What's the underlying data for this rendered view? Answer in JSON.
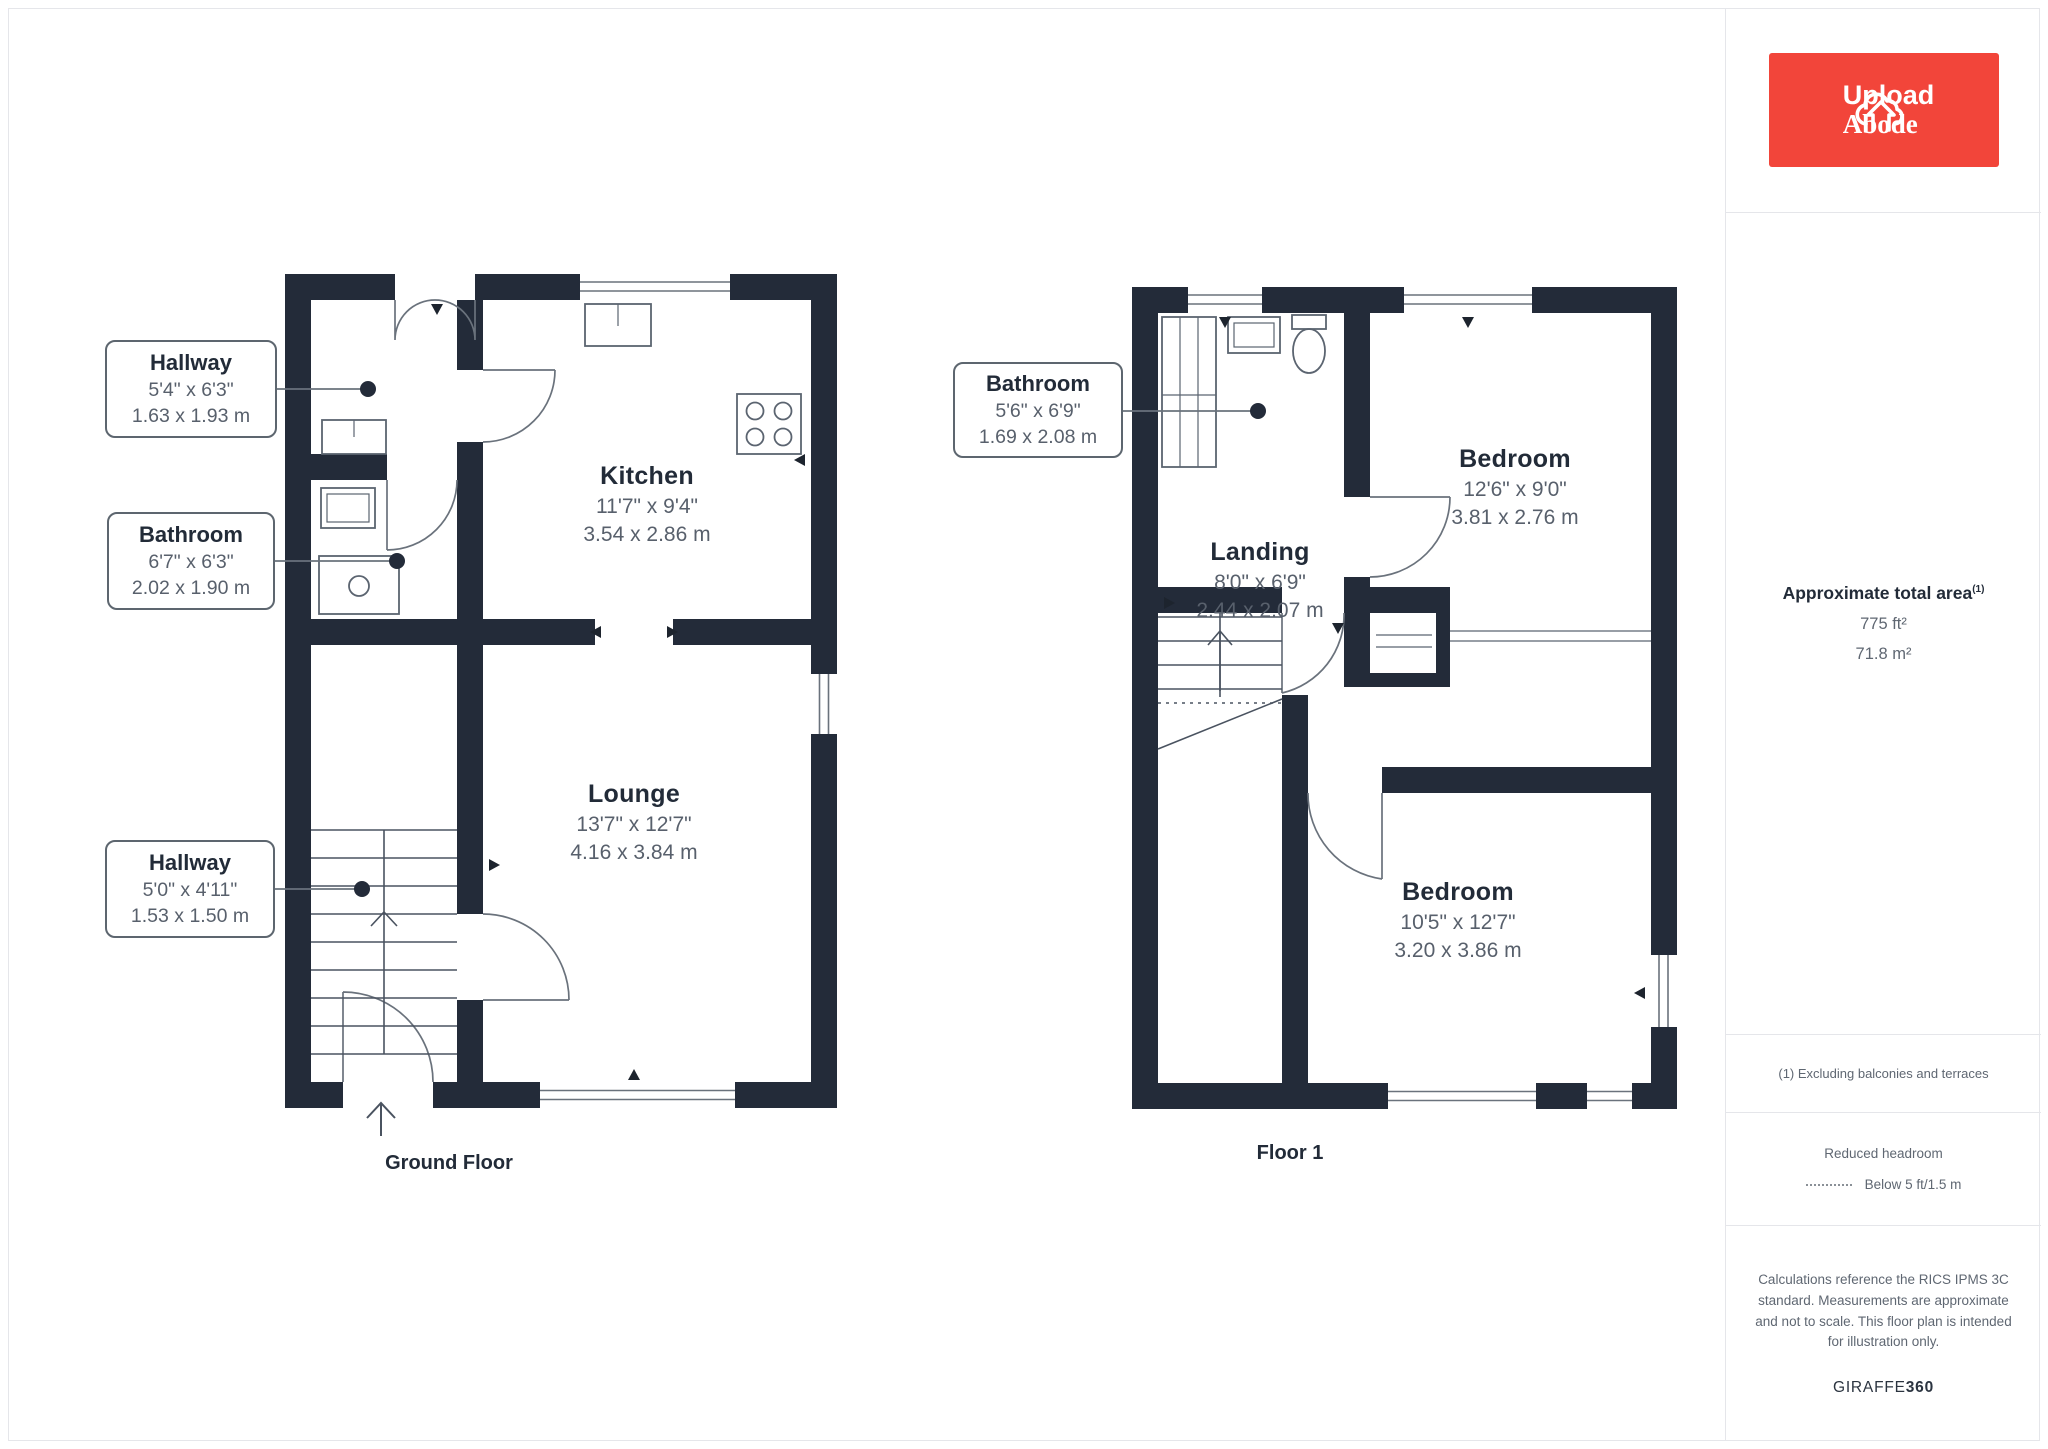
{
  "brand": {
    "logo_line1": "Upload",
    "logo_line2": "Abode"
  },
  "sidebar": {
    "area_title": "Approximate total area",
    "area_note_ref": "(1)",
    "area_imperial": "775 ft²",
    "area_metric": "71.8 m²",
    "footnote": "(1) Excluding balconies and terraces",
    "headroom_title": "Reduced headroom",
    "headroom_legend": "Below 5 ft/1.5 m",
    "disclaimer": "Calculations reference the RICS IPMS 3C standard. Measurements are approximate and not to scale. This floor plan is intended for illustration only.",
    "brand_name": "GIRAFFE",
    "brand_suffix": "360"
  },
  "ground_floor": {
    "caption": "Ground Floor",
    "rooms": {
      "kitchen": {
        "name": "Kitchen",
        "imperial": "11'7\" x 9'4\"",
        "metric": "3.54 x 2.86 m"
      },
      "lounge": {
        "name": "Lounge",
        "imperial": "13'7\" x 12'7\"",
        "metric": "4.16 x 3.84 m"
      }
    },
    "tags": {
      "hallway_top": {
        "name": "Hallway",
        "imperial": "5'4\" x 6'3\"",
        "metric": "1.63 x 1.93 m"
      },
      "bathroom": {
        "name": "Bathroom",
        "imperial": "6'7\" x 6'3\"",
        "metric": "2.02 x 1.90 m"
      },
      "hallway_bottom": {
        "name": "Hallway",
        "imperial": "5'0\" x 4'11\"",
        "metric": "1.53 x 1.50 m"
      }
    }
  },
  "floor1": {
    "caption": "Floor 1",
    "rooms": {
      "landing": {
        "name": "Landing",
        "imperial": "8'0\" x 6'9\"",
        "metric": "2.44 x 2.07 m"
      },
      "bedroom_top": {
        "name": "Bedroom",
        "imperial": "12'6\" x 9'0\"",
        "metric": "3.81 x 2.76 m"
      },
      "bedroom_bottom": {
        "name": "Bedroom",
        "imperial": "10'5\" x 12'7\"",
        "metric": "3.20 x 3.86 m"
      }
    },
    "tags": {
      "bathroom": {
        "name": "Bathroom",
        "imperial": "5'6\" x 6'9\"",
        "metric": "1.69 x 2.08 m"
      }
    }
  }
}
